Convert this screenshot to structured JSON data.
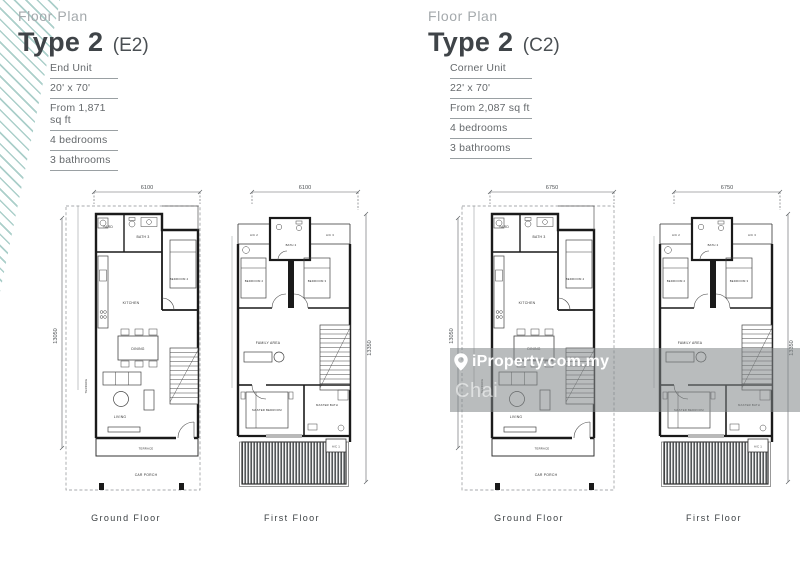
{
  "watermark": {
    "brand": "iProperty.com.my",
    "user": "Chai"
  },
  "units": {
    "e2": {
      "eyebrow": "Floor Plan",
      "title": "Type 2",
      "code": "(E2)",
      "specs": [
        "End Unit",
        "20' x 70'",
        "From 1,871 sq ft",
        "4 bedrooms",
        "3 bathrooms"
      ]
    },
    "c2": {
      "eyebrow": "Floor Plan",
      "title": "Type 2",
      "code": "(C2)",
      "specs": [
        "Corner Unit",
        "22' x 70'",
        "From 2,087 sq ft",
        "4 bedrooms",
        "3 bathrooms"
      ]
    }
  },
  "plans": {
    "e2_ground": {
      "label": "Ground Floor",
      "width_dim": "6100",
      "height_dim": "13050",
      "rooms": {
        "yard": "YARD",
        "bath": "BATH 3",
        "kitchen": "KITCHEN",
        "bedroom4": "BEDROOM 4",
        "dining": "DINING",
        "terrace_side": "TERRACE",
        "living": "LIVING",
        "terrace": "TERRACE",
        "car_porch": "CAR PORCH"
      }
    },
    "e2_first": {
      "label": "First Floor",
      "width_dim": "6100",
      "height_dim": "13350",
      "rooms": {
        "ac2": "A/C 2",
        "bath2": "BATH 2",
        "ac3": "A/C 3",
        "bedroom2": "BEDROOM 2",
        "bedroom3": "BEDROOM 3",
        "family": "FAMILY AREA",
        "master_bedroom": "MASTER BEDROOM",
        "master_bath": "MASTER BATH",
        "ac1": "A/C 1"
      }
    },
    "c2_ground": {
      "label": "Ground Floor",
      "width_dim": "6750",
      "height_dim": "13050",
      "rooms": {
        "yard": "YARD",
        "bath": "BATH 3",
        "kitchen": "KITCHEN",
        "bedroom4": "BEDROOM 4",
        "dining": "DINING",
        "terrace_side": "TERRACE",
        "living": "LIVING",
        "terrace": "TERRACE",
        "car_porch": "CAR PORCH"
      }
    },
    "c2_first": {
      "label": "First Floor",
      "width_dim": "6750",
      "height_dim": "13350",
      "rooms": {
        "ac2": "A/C 2",
        "bath2": "BATH 2",
        "ac3": "A/C 3",
        "bedroom2": "BEDROOM 2",
        "bedroom3": "BEDROOM 3",
        "family": "FAMILY AREA",
        "master_bedroom": "MASTER BEDROOM",
        "master_bath": "MASTER BATH",
        "ac1": "A/C 1"
      }
    }
  }
}
